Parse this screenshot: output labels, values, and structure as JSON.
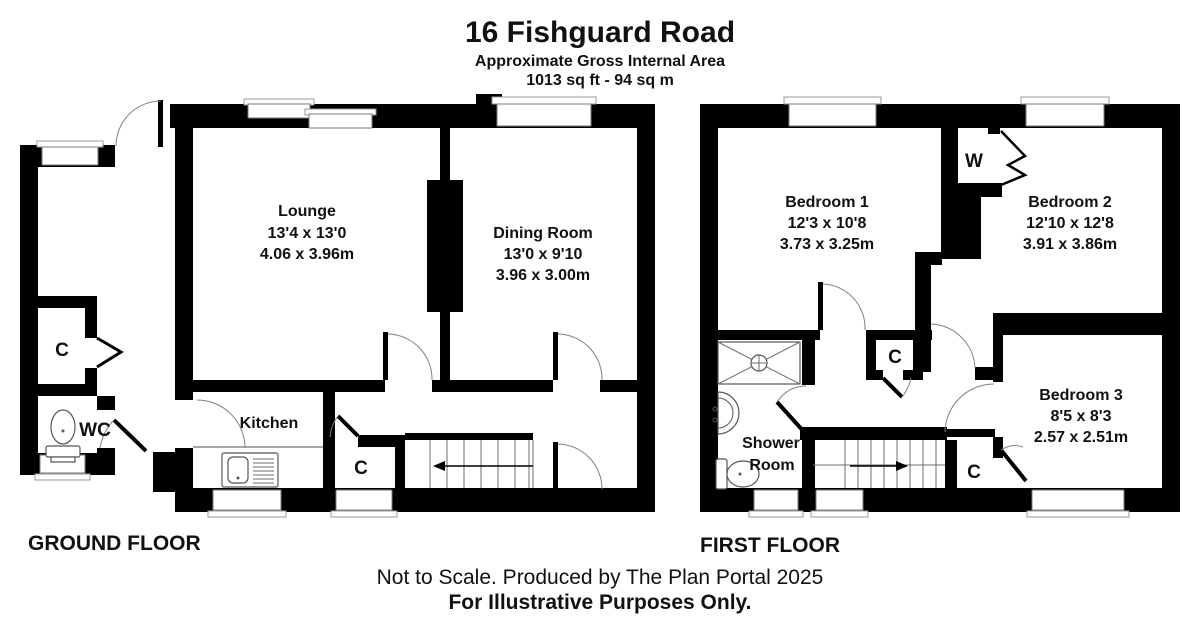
{
  "header": {
    "title": "16 Fishguard Road",
    "subtitle": "Approximate Gross Internal Area",
    "area": "1013 sq ft - 94 sq m"
  },
  "ground_floor": {
    "label": "GROUND FLOOR",
    "lounge": {
      "name": "Lounge",
      "imperial": "13'4 x 13'0",
      "metric": "4.06 x 3.96m"
    },
    "dining_room": {
      "name": "Dining Room",
      "imperial": "13'0 x 9'10",
      "metric": "3.96 x 3.00m"
    },
    "kitchen": {
      "name": "Kitchen"
    },
    "wc": {
      "name": "WC"
    },
    "closet_entrance": {
      "name": "C"
    },
    "closet_hall": {
      "name": "C"
    }
  },
  "first_floor": {
    "label": "FIRST FLOOR",
    "bedroom1": {
      "name": "Bedroom 1",
      "imperial": "12'3 x 10'8",
      "metric": "3.73 x 3.25m"
    },
    "bedroom2": {
      "name": "Bedroom 2",
      "imperial": "12'10 x 12'8",
      "metric": "3.91 x 3.86m"
    },
    "bedroom3": {
      "name": "Bedroom 3",
      "imperial": "8'5 x 8'3",
      "metric": "2.57 x 2.51m"
    },
    "shower_room": {
      "line1": "Shower",
      "line2": "Room"
    },
    "wardrobe": {
      "name": "W"
    },
    "closet_hall": {
      "name": "C"
    },
    "closet_stairs": {
      "name": "C"
    }
  },
  "footer": {
    "line1": "Not to Scale. Produced by The Plan Portal 2025",
    "line2": "For Illustrative Purposes Only."
  },
  "colors": {
    "wall": "#000000",
    "background": "#ffffff",
    "detail_line": "#808080"
  }
}
